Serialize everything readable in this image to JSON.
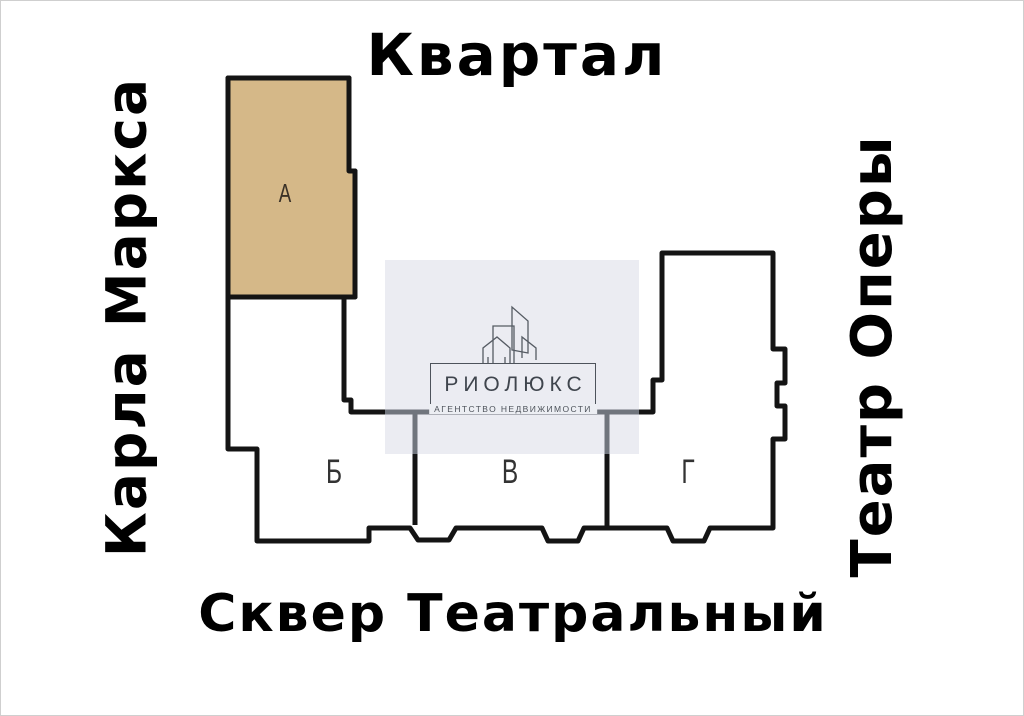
{
  "map": {
    "title_top": "Квартал",
    "street_left": "Карла Маркса",
    "street_right": "Театр Оперы",
    "street_bottom": "Сквер Театральный",
    "sections": [
      {
        "label": "А",
        "highlighted": true,
        "fill": "#d5b888"
      },
      {
        "label": "Б",
        "highlighted": false,
        "fill": "#ffffff"
      },
      {
        "label": "В",
        "highlighted": false,
        "fill": "#ffffff"
      },
      {
        "label": "Г",
        "highlighted": false,
        "fill": "#ffffff"
      }
    ],
    "outline_color": "#141414",
    "highlight_color": "#d5b888",
    "watermark_bg_color": "#eceef3"
  },
  "watermark": {
    "agency_name": "РИОЛЮКС",
    "tagline": "АГЕНТСТВО НЕДВИЖИМОСТИ"
  }
}
